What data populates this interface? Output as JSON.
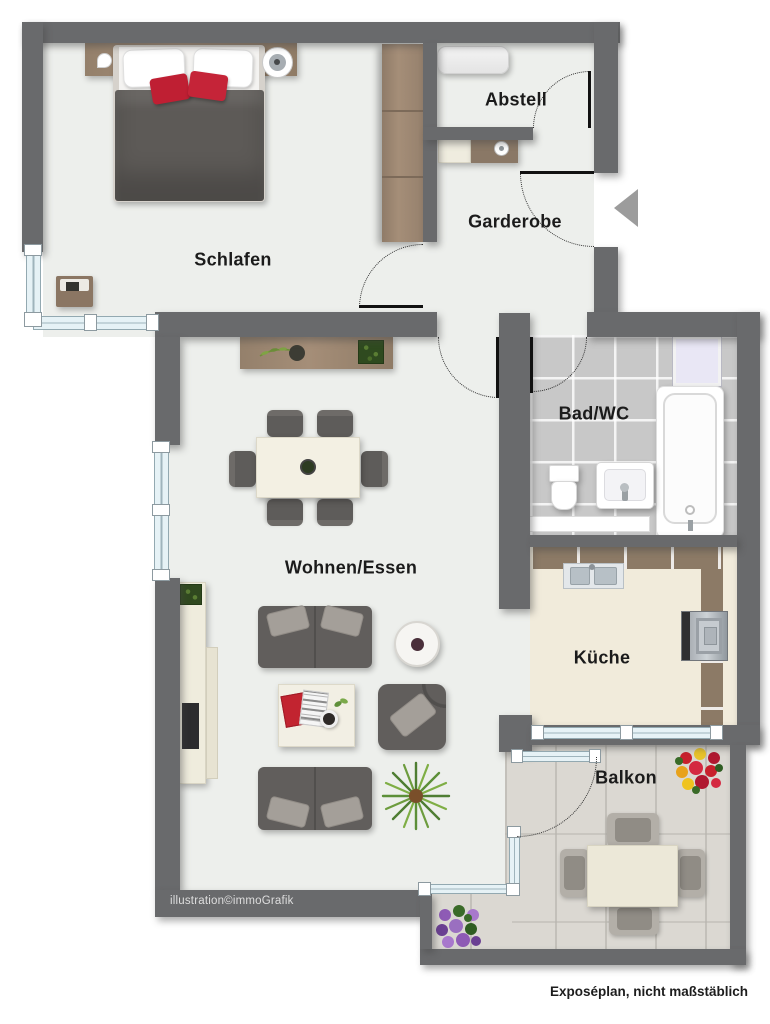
{
  "plan": {
    "rooms": {
      "schlafen": "Schlafen",
      "abstell": "Abstell",
      "garderobe": "Garderobe",
      "bad": "Bad/WC",
      "wohnen": "Wohnen/Essen",
      "kueche": "Küche",
      "balkon": "Balkon"
    },
    "credits": {
      "illustration": "illustration©immoGrafik",
      "disclaimer": "Exposéplan, nicht maßstäblich"
    },
    "colors": {
      "wall": "#696a6c",
      "floor": "#edefec",
      "bathroom_tile": "#c8c8c8",
      "kitchen_floor_tile": "#ead7c6",
      "kitchen_cabinet": "#8c7a66",
      "balcony_tile": "#dbd8d2",
      "window_glass": "#e6f2f6",
      "wood": "#a18a73",
      "sofa": "#615e5c",
      "cushion": "#a49f99",
      "accent_red": "#bf1f33",
      "entrance_arrow": "#9c9c9c"
    }
  }
}
